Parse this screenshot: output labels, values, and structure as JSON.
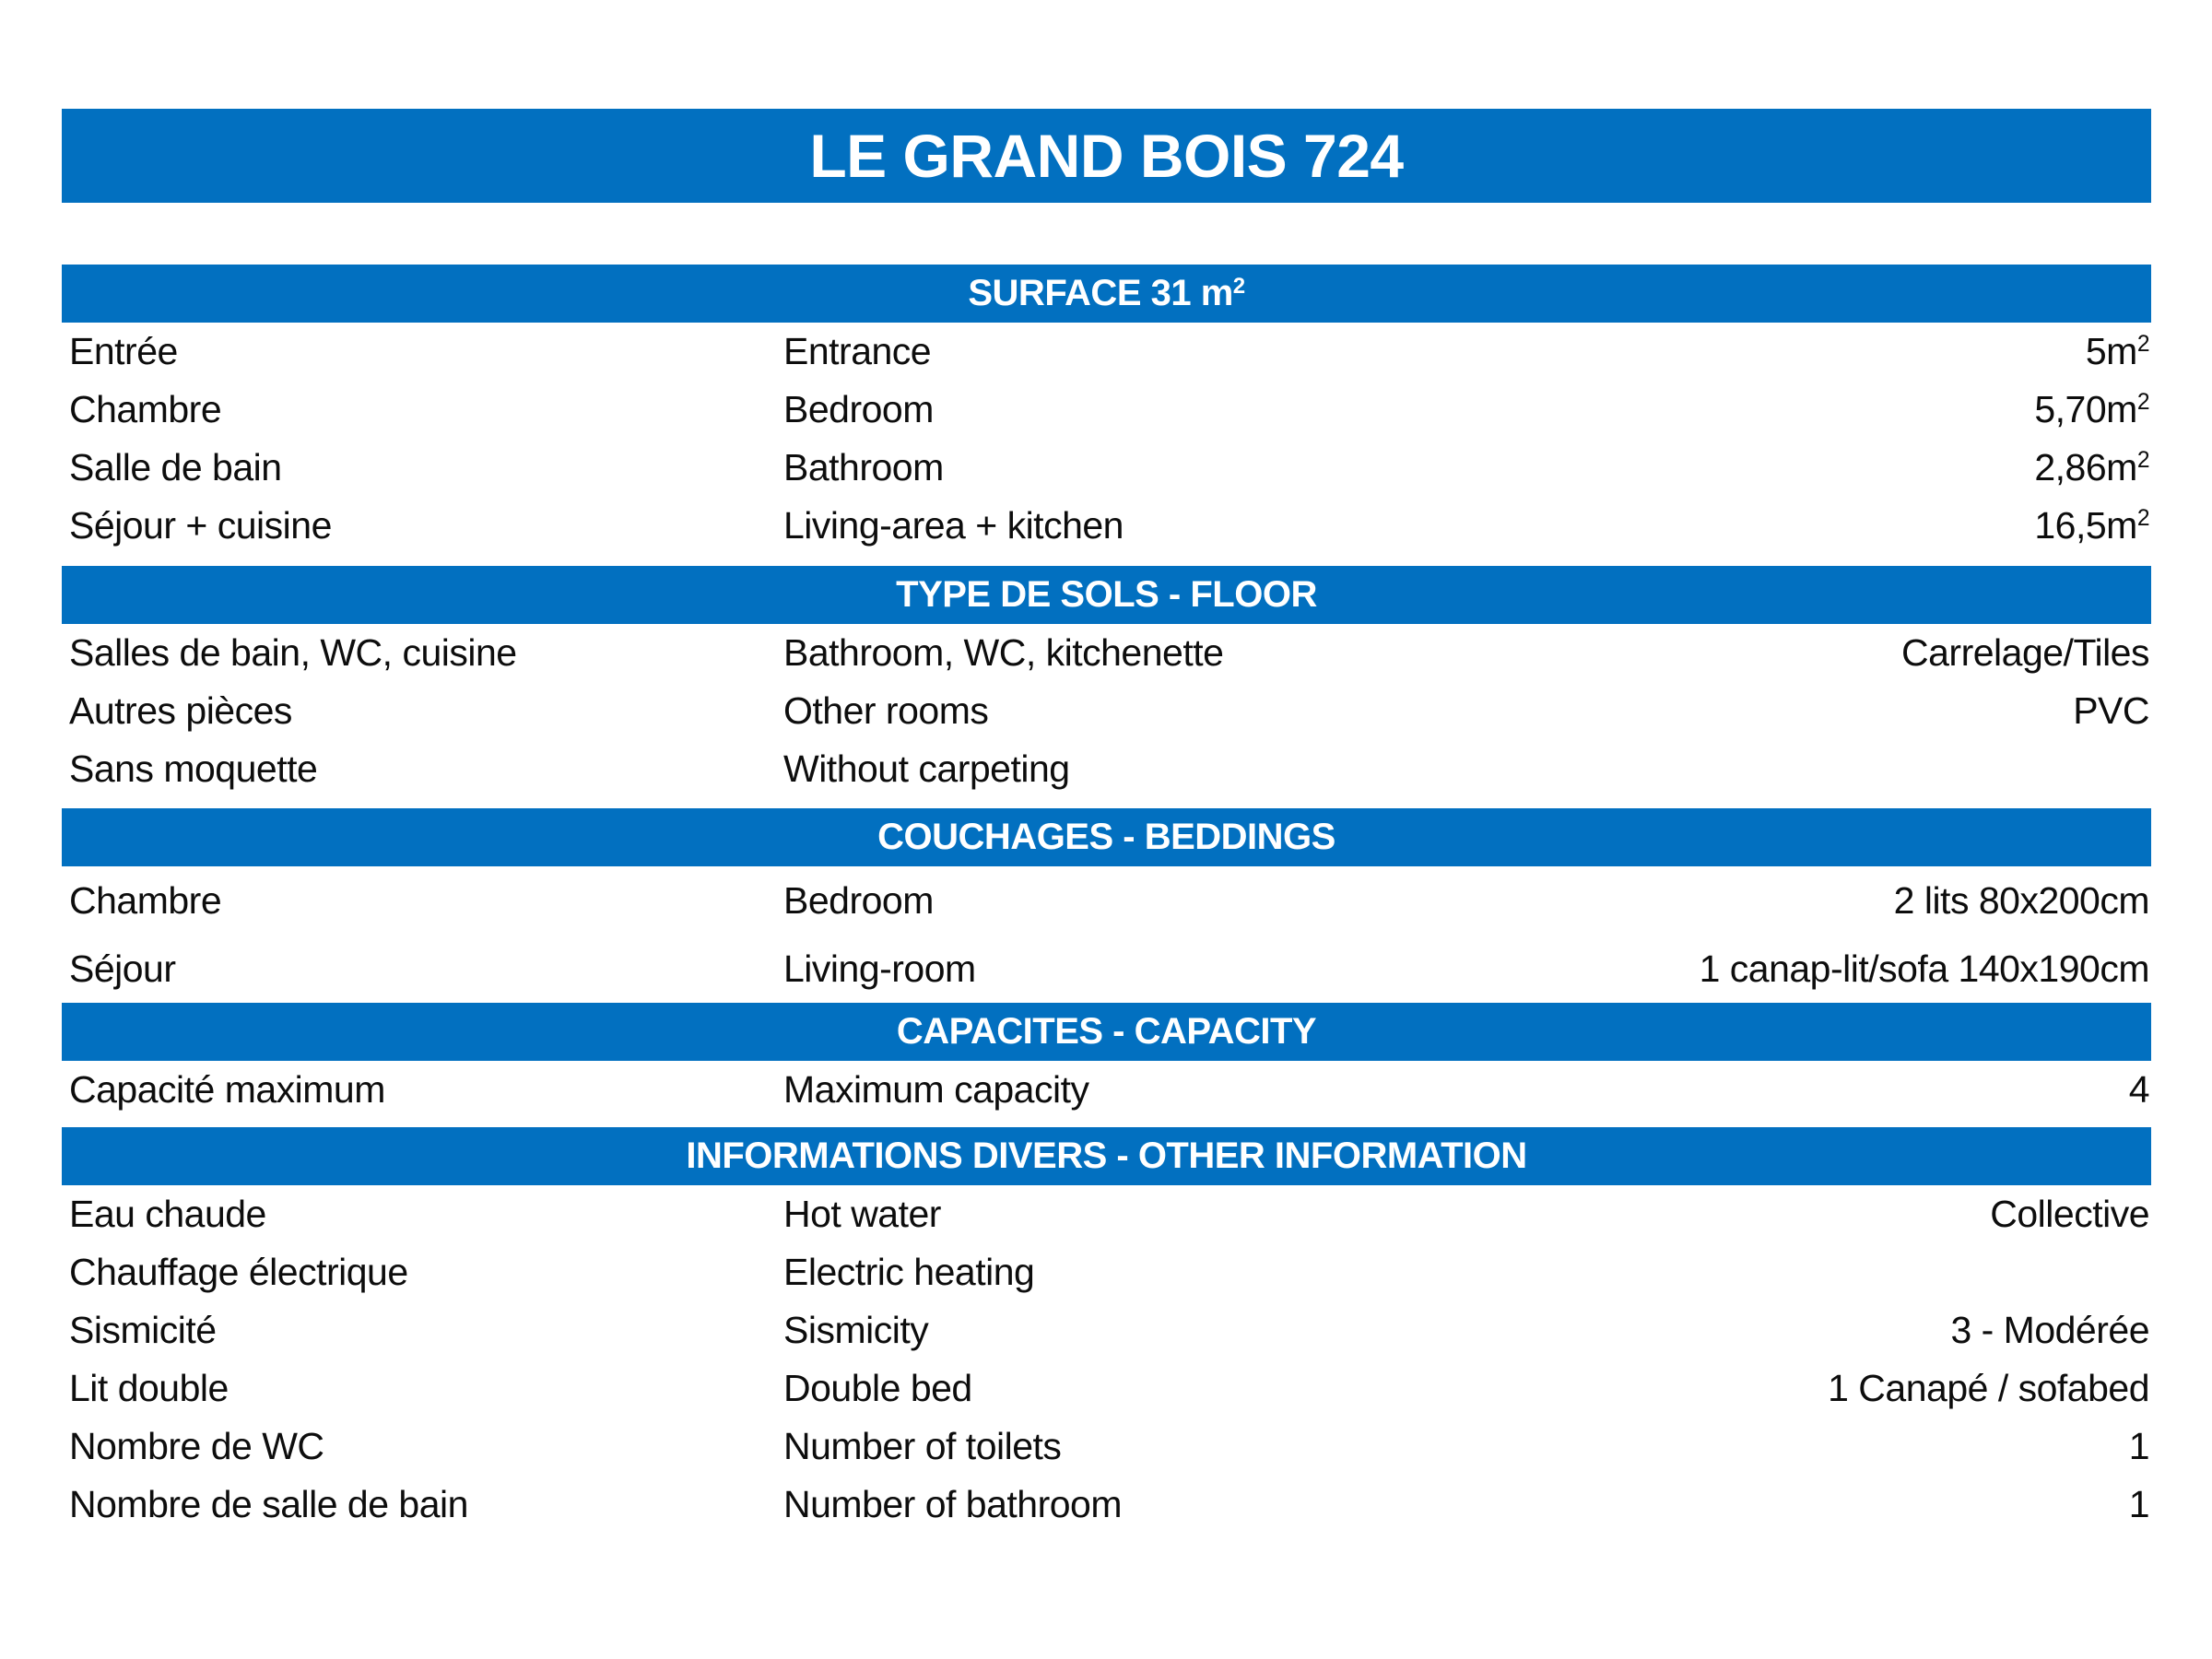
{
  "colors": {
    "accent_blue": "#0270c0",
    "bar_text": "#ffffff",
    "body_text": "#0d0d0d",
    "background": "#ffffff"
  },
  "title": "LE GRAND BOIS 724",
  "sections": [
    {
      "title": "SURFACE 31 m²",
      "rows": [
        {
          "fr": "Entrée",
          "en": "Entrance",
          "value": "5m²"
        },
        {
          "fr": "Chambre",
          "en": "Bedroom",
          "value": "5,70m²"
        },
        {
          "fr": "Salle de bain",
          "en": "Bathroom",
          "value": "2,86m²"
        },
        {
          "fr": "Séjour + cuisine",
          "en": "Living-area + kitchen",
          "value": "16,5m²"
        }
      ]
    },
    {
      "title": "TYPE DE SOLS - FLOOR",
      "rows": [
        {
          "fr": "Salles de bain, WC, cuisine",
          "en": "Bathroom, WC, kitchenette",
          "value": "Carrelage/Tiles"
        },
        {
          "fr": "Autres pièces",
          "en": "Other rooms",
          "value": "PVC"
        },
        {
          "fr": "Sans moquette",
          "en": "Without carpeting",
          "value": ""
        }
      ]
    },
    {
      "title": "COUCHAGES - BEDDINGS",
      "rows": [
        {
          "fr": "Chambre",
          "en": "Bedroom",
          "value": "2 lits 80x200cm"
        },
        {
          "fr": "Séjour",
          "en": "Living-room",
          "value": "1 canap-lit/sofa 140x190cm"
        }
      ]
    },
    {
      "title": "CAPACITES - CAPACITY",
      "rows": [
        {
          "fr": "Capacité maximum",
          "en": "Maximum capacity",
          "value": "4"
        }
      ]
    },
    {
      "title": "INFORMATIONS DIVERS - OTHER INFORMATION",
      "rows": [
        {
          "fr": "Eau chaude",
          "en": "Hot water",
          "value": "Collective"
        },
        {
          "fr": "Chauffage électrique",
          "en": "Electric heating",
          "value": ""
        },
        {
          "fr": "Sismicité",
          "en": "Sismicity",
          "value": "3 - Modérée"
        },
        {
          "fr": "Lit double",
          "en": "Double bed",
          "value": "1 Canapé / sofabed"
        },
        {
          "fr": "Nombre de WC",
          "en": "Number of toilets",
          "value": "1"
        },
        {
          "fr": "Nombre de salle de bain",
          "en": "Number of bathroom",
          "value": "1"
        }
      ]
    }
  ]
}
